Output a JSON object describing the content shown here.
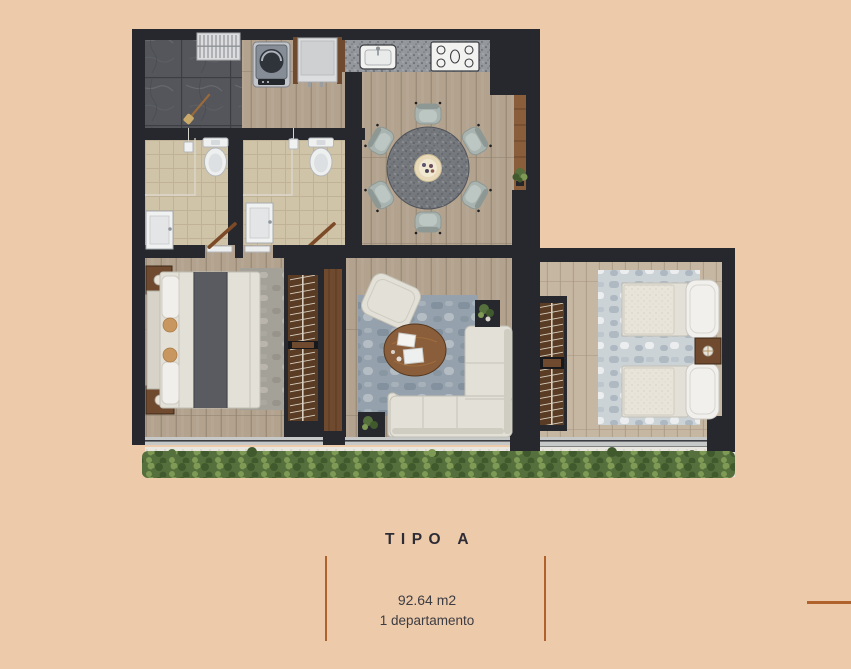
{
  "palette": {
    "bg": "#edcaaa",
    "accent": "#b0622c",
    "title-color": "#2d2c35",
    "text-color": "#3d3c42",
    "wall": "#26282d",
    "wood": "#b2a28e",
    "wood-line": "#9c8d7a",
    "wood2": "#c6b7a3",
    "wood2-line": "#b0a18d",
    "stone": "#54565b",
    "stone-grid": "#3c3e43",
    "tile": "#cfc3a8",
    "tile-line": "#bfb296",
    "granite": "#94989d",
    "granite-dark": "#75797e",
    "granite-dot": "#4e5257",
    "cream": "#e3e0d7",
    "cream-shadow": "#c2bfb4",
    "sage": "#a9b4b0",
    "rug-blue": "#95a1ac",
    "rug-blue-dark": "#73828f",
    "rug-light-spot": "#d3d8db",
    "rug-light": "#ccd3d7",
    "rug-gray": "#a4a198",
    "closet-wood": "#5a3c25",
    "wood-brown": "#6f4a2f",
    "wood-brown-light": "#8a5e3b",
    "runner": "#595b60",
    "track": "#c7c9c8",
    "glass": "#3a3d41",
    "gravel": "#e9e6df",
    "gravel-dot": "#cbc7bf",
    "plant": "#55703c",
    "plant-dark": "#415a2d",
    "plant-light": "#7f9a55",
    "lamp": "#e8e4da",
    "pillow-tan": "#c8965f",
    "white": "#f2f2f1"
  },
  "caption": {
    "title": "TIPO A",
    "area": "92.64 m2",
    "units": "1 departamento"
  }
}
